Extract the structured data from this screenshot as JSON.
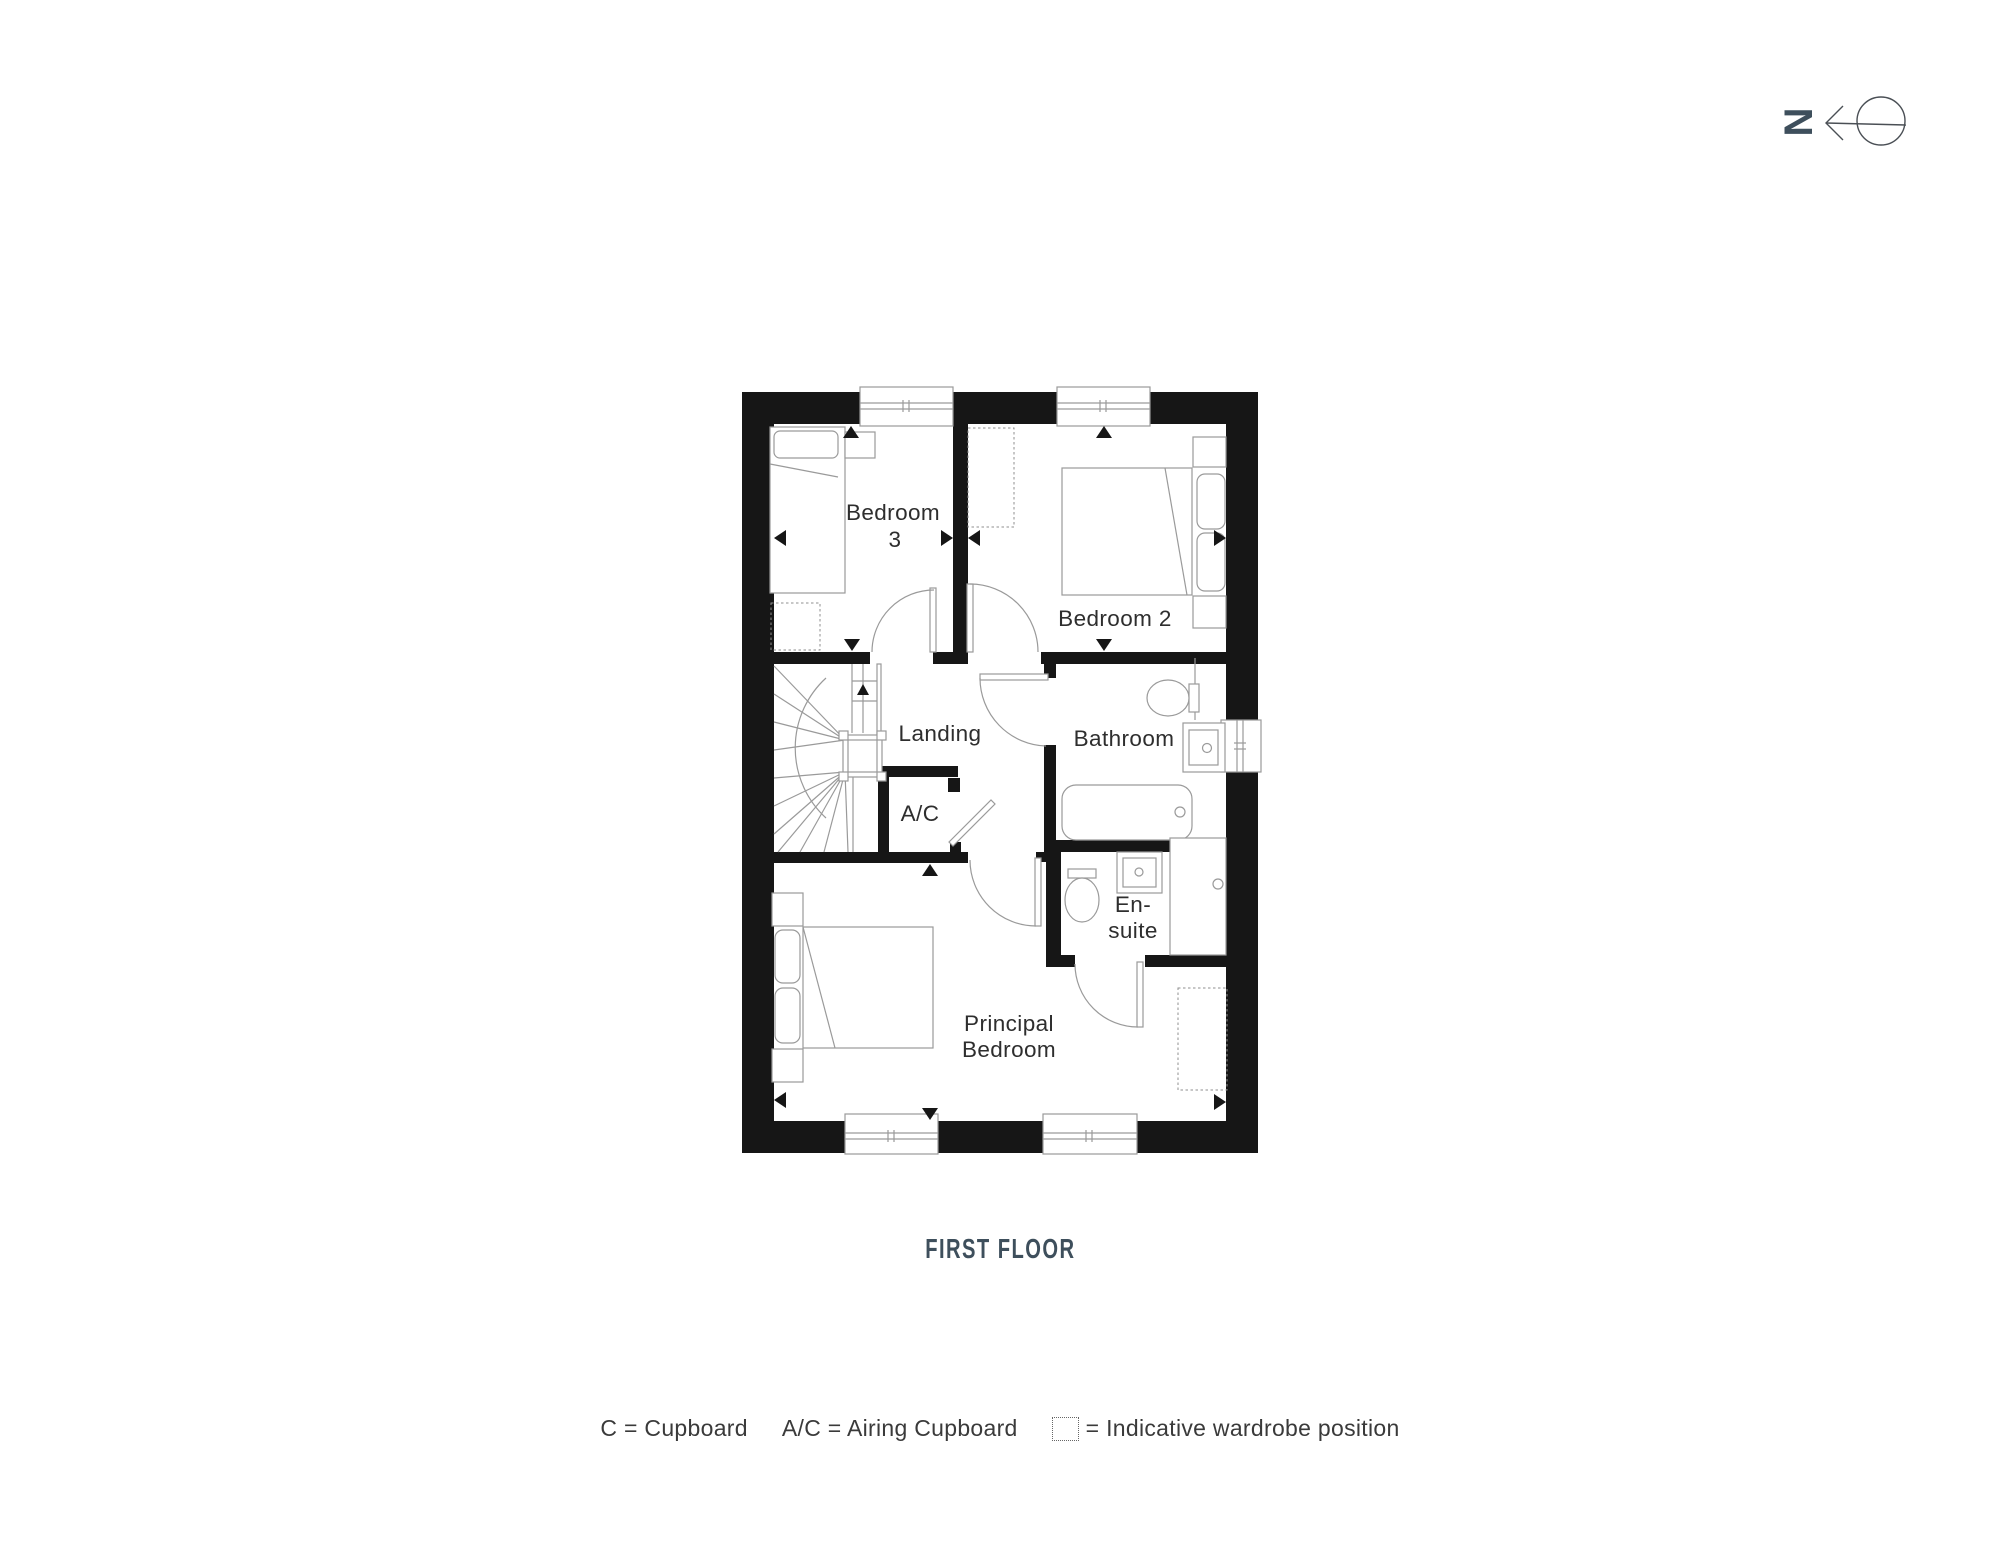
{
  "title": "FIRST FLOOR",
  "compass": {
    "letter": "N"
  },
  "plan": {
    "rooms": {
      "bedroom3_line1": "Bedroom",
      "bedroom3_line2": "3",
      "bedroom2": "Bedroom 2",
      "landing": "Landing",
      "bathroom": "Bathroom",
      "ac": "A/C",
      "ensuite_line1": "En-",
      "ensuite_line2": "suite",
      "principal_line1": "Principal",
      "principal_line2": "Bedroom"
    }
  },
  "legend": {
    "cupboard": "C = Cupboard",
    "airing_cupboard": "A/C = Airing Cupboard",
    "wardrobe": "= Indicative wardrobe position"
  },
  "colors": {
    "accent": "#3E4F5C",
    "wall": "#161616",
    "line": "#9A9A9A",
    "label": "#2E2E2E"
  }
}
